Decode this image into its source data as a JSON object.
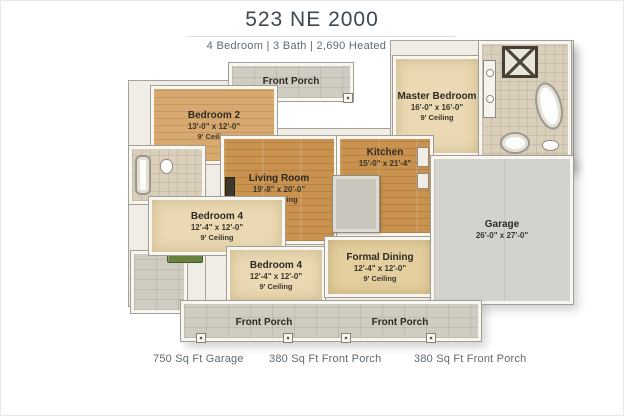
{
  "header": {
    "title": "523 NE 2000",
    "subtitle": "4 Bedroom | 3 Bath | 2,690 Heated Sq Ft"
  },
  "floorplan": {
    "rooms": [
      {
        "id": "front-porch-top",
        "name": "Front Porch"
      },
      {
        "id": "master-bedroom",
        "name": "Master Bedroom",
        "dims": "16'-0\" x 16'-0\"",
        "ceiling": "9' Ceiling"
      },
      {
        "id": "bedroom-2",
        "name": "Bedroom 2",
        "dims": "13'-0\" x 12'-0\"",
        "ceiling": "9' Ceiling"
      },
      {
        "id": "living-room",
        "name": "Living Room",
        "dims": "19'-8\" x 20'-0\"",
        "ceiling": "10' Ceiling"
      },
      {
        "id": "kitchen",
        "name": "Kitchen",
        "dims": "15'-0\" x 21'-4\""
      },
      {
        "id": "bedroom-4-left",
        "name": "Bedroom 4",
        "dims": "12'-4\" x 12'-0\"",
        "ceiling": "9' Ceiling"
      },
      {
        "id": "bedroom-4-front",
        "name": "Bedroom 4",
        "dims": "12'-4\" x 12'-0\"",
        "ceiling": "9' Ceiling"
      },
      {
        "id": "formal-dining",
        "name": "Formal Dining",
        "dims": "12'-4\" x 12'-0\"",
        "ceiling": "9' Ceiling"
      },
      {
        "id": "garage",
        "name": "Garage",
        "dims": "26'-0\" x 27'-0\""
      },
      {
        "id": "front-porch-bottom-left",
        "name": "Front Porch"
      },
      {
        "id": "front-porch-bottom-right",
        "name": "Front Porch"
      }
    ]
  },
  "footer": {
    "stats": [
      "750 Sq Ft Garage",
      "380 Sq Ft Front Porch",
      "380 Sq Ft Front Porch"
    ]
  },
  "colors": {
    "wood_floor": "#c9924f",
    "carpet": "#ead9b2",
    "stone_porch": "#cfccc2",
    "tile": "#d9cfba",
    "garage_floor": "#d3d2cc",
    "wall": "#f8f6f0",
    "title_text": "#3d4852",
    "body_text": "#5f6a72"
  }
}
